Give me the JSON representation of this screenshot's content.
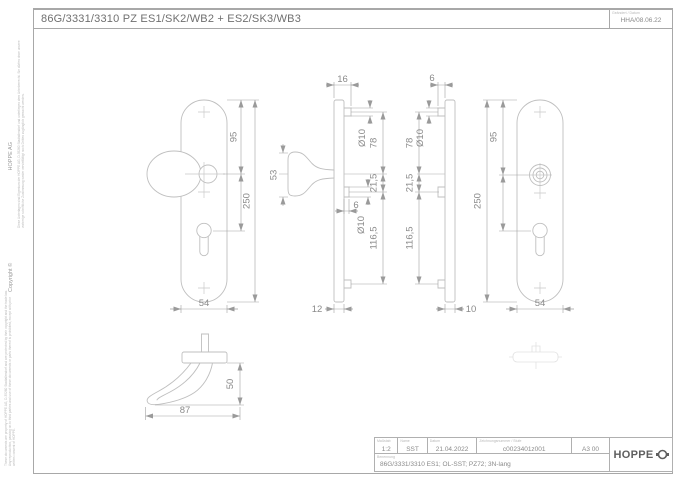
{
  "header": {
    "title": "86G/3331/3310 PZ ES1/SK2/WB2 + ES2/SK3/WB3",
    "revision_label": "Geändert / Datum",
    "revision": "HHA/08.06.22"
  },
  "margin": {
    "copyright": "Copyright ©",
    "company": "HOPPE  AG",
    "notice_de": "Diese Unterlagen sind Eigentum der HOPPE AG, D-35260 Stadtallendorf und unterliegen dem Urheberrecht. Sie dürfen ohne unsere vorherige schriftliche Zustimmung weder vervielfältigt noch Dritten zugänglich gemacht werden.",
    "notice_en": "These documents are property of HOPPE AG, D-35260 Stadtallendorf and are protected by their copyright and the trade law. Any reproduction, passing on to third parties and use of these documents or parts thereof is prohibited, except with prior written consent of HOPPE."
  },
  "dims": {
    "v1_95": "95",
    "v1_250": "250",
    "v1_54": "54",
    "v2_16": "16",
    "v2_d10a": "Ø10",
    "v2_78": "78",
    "v2_53": "53",
    "v2_215": "21,5",
    "v2_6": "6",
    "v2_d10b": "Ø10",
    "v2_1165": "116,5",
    "v2_12": "12",
    "v3_6": "6",
    "v3_d10": "Ø10",
    "v3_78": "78",
    "v3_215": "21,5",
    "v3_1165": "116,5",
    "v3_10": "10",
    "v4_95": "95",
    "v4_250": "250",
    "v4_54": "54",
    "v5_50": "50",
    "v5_87": "87"
  },
  "titleblock": {
    "scale_label": "Maßstab",
    "scale": "1:2",
    "name_label": "Name",
    "name": "SST",
    "date_label": "Datum",
    "date": "21.04.2022",
    "number_label": "Zeichnungsnummer / Stufe",
    "number": "c0023401z001",
    "format": "A3 00",
    "description_label": "Benennung",
    "description": "86G/3331/3310  ES1; OL-SST; PZ72; 3N-lang",
    "brand": "HOPPE"
  }
}
